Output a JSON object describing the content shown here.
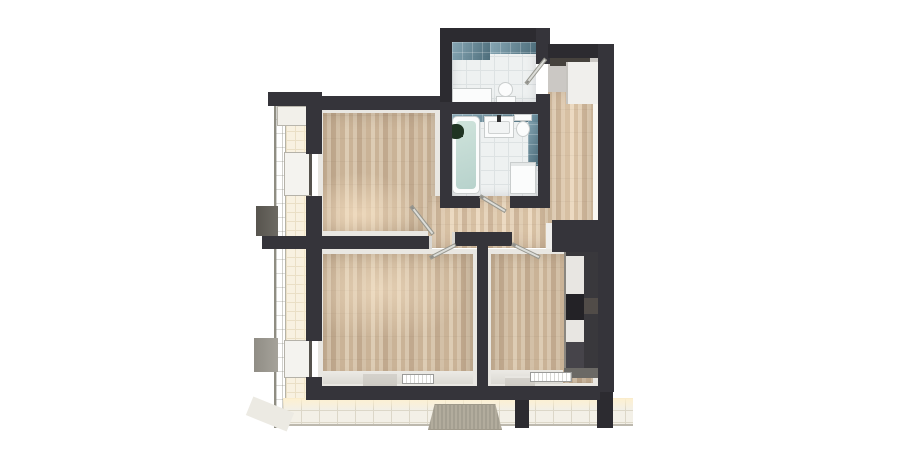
{
  "scene": {
    "description": "3D rendered top-down floor plan of a two-room apartment with wrap-around balcony, no visible text labels",
    "view": "orthographic top-down cutaway render",
    "background": "#ffffff"
  },
  "palette": {
    "bg": "#ffffff",
    "wall": "#35343a",
    "wall-dark": "#2c2b30",
    "wood-a": "#cab397",
    "wood-b": "#d8c6ae",
    "wood-c": "#c1a98e",
    "wood-d": "#d3c0a7",
    "wood-e": "#ddccb4",
    "baseboard": "#e9e7e2",
    "tile": "#eef1f1",
    "tile-line": "#dde2e3",
    "teal-1": "#6d97a6",
    "teal-2": "#4d7584",
    "balc": "#f8f1e1",
    "balc-line": "#eadfc6",
    "terr": "#f3f0e7",
    "terr-line": "#dcd7c8",
    "fixture": "#fbfcfc",
    "fixture-line": "#c9cdcd",
    "cab": "#39383c",
    "marble": "#e8e6e2",
    "cab-brown": "#514c48",
    "oven": "#232226",
    "mat": "#b2ac9d",
    "leaf": "#dcddd9",
    "glass-a": "#ecece3",
    "glass-b": "#dcddd2",
    "nook": "#cbc8c4",
    "entrydoor": "#46423d",
    "water": "#cfe3db",
    "plant": "#1f3322"
  },
  "rooms": [
    {
      "id": "bedroom",
      "floor": "wood parquet",
      "position": "top-left"
    },
    {
      "id": "living-room",
      "floor": "wood parquet",
      "position": "bottom-left"
    },
    {
      "id": "kitchen-living",
      "floor": "wood parquet",
      "position": "bottom-right",
      "features": [
        "kitchen cabinets",
        "oven"
      ]
    },
    {
      "id": "hallway",
      "floor": "wood parquet",
      "position": "center"
    },
    {
      "id": "corridor",
      "floor": "wood parquet",
      "position": "right"
    },
    {
      "id": "entry-nook",
      "floor": "gray screed",
      "position": "top-right",
      "features": [
        "entry door",
        "wardrobe"
      ]
    },
    {
      "id": "wc",
      "floor": "white tile",
      "walls": "teal tile",
      "position": "top-center",
      "features": [
        "toilet",
        "counter"
      ]
    },
    {
      "id": "bathroom",
      "floor": "white tile",
      "walls": "teal tile",
      "position": "center-top",
      "features": [
        "bathtub",
        "vanity sink",
        "toilet",
        "washing machine",
        "plant"
      ]
    },
    {
      "id": "balcony-left",
      "floor": "cream tile",
      "features": [
        "glass railing",
        "privacy fins",
        "window sills"
      ]
    },
    {
      "id": "terrace-bottom",
      "floor": "light tile",
      "features": [
        "doormat",
        "support posts"
      ]
    }
  ],
  "fixtures": [
    "bathtub",
    "bathtub-water",
    "bathtub-plant",
    "vanity-sink",
    "faucet",
    "toilet-bathroom",
    "toilet-wc",
    "wc-counter",
    "washing-machine",
    "kitchen-cabinet-run",
    "oven",
    "counter-marble",
    "radiator-living",
    "radiator-kitchen",
    "doormat",
    "entry-door",
    "wardrobe",
    "glass-railing",
    "privacy-fin-upper",
    "privacy-fin-lower",
    "window-sill-bedroom",
    "window-sill-living",
    "balcony-unit-box",
    "door-leaf-bedroom",
    "door-leaf-living",
    "door-leaf-kitchen",
    "door-leaf-bathroom",
    "door-leaf-wc",
    "threshold-living",
    "threshold-kitchen",
    "support-post-1",
    "support-post-2"
  ]
}
